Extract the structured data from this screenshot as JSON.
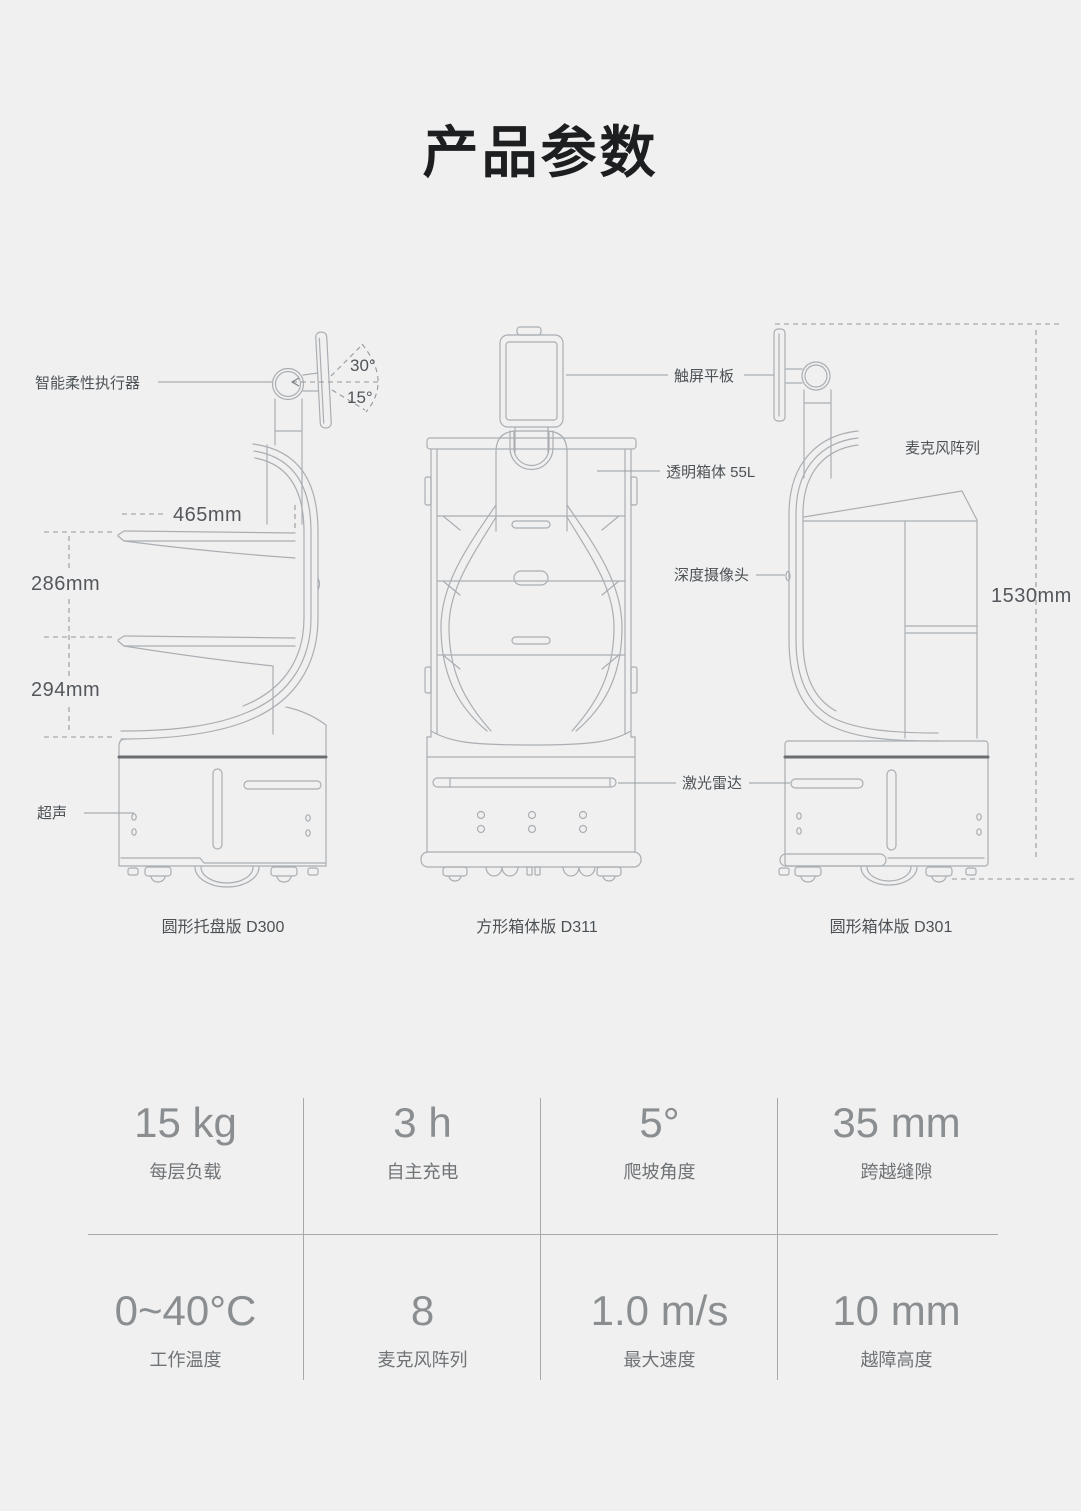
{
  "page": {
    "title": "产品参数",
    "background": "#f0f0f0"
  },
  "diagram": {
    "annotations": {
      "actuator": "智能柔性执行器",
      "angle_up": "30°",
      "angle_down": "15°",
      "tray_width": "465mm",
      "tray_gap_upper": "286mm",
      "tray_gap_lower": "294mm",
      "ultrasonic": "超声",
      "tablet": "触屏平板",
      "transparent_box": "透明箱体 55L",
      "depth_camera": "深度摄像头",
      "lidar": "激光雷达",
      "mic_array": "麦克风阵列",
      "total_height": "1530mm"
    },
    "robots": [
      {
        "id": "d300",
        "caption": "圆形托盘版 D300"
      },
      {
        "id": "d311",
        "caption": "方形箱体版 D311"
      },
      {
        "id": "d301",
        "caption": "圆形箱体版 D301"
      }
    ]
  },
  "specs": {
    "rows": [
      [
        {
          "value": "15 kg",
          "label": "每层负载"
        },
        {
          "value": "3 h",
          "label": "自主充电"
        },
        {
          "value": "5°",
          "label": "爬坡角度"
        },
        {
          "value": "35 mm",
          "label": "跨越缝隙"
        }
      ],
      [
        {
          "value": "0~40°C",
          "label": "工作温度"
        },
        {
          "value": "8",
          "label": "麦克风阵列"
        },
        {
          "value": "1.0 m/s",
          "label": "最大速度"
        },
        {
          "value": "10 mm",
          "label": "越障高度"
        }
      ]
    ]
  },
  "colors": {
    "line_art": "#aaaeb2",
    "dark_band": "#6a6e71",
    "text_dark": "#4d5256",
    "spec_value": "#8b8e90",
    "spec_label": "#6f7376",
    "background": "#f0f0f0"
  }
}
